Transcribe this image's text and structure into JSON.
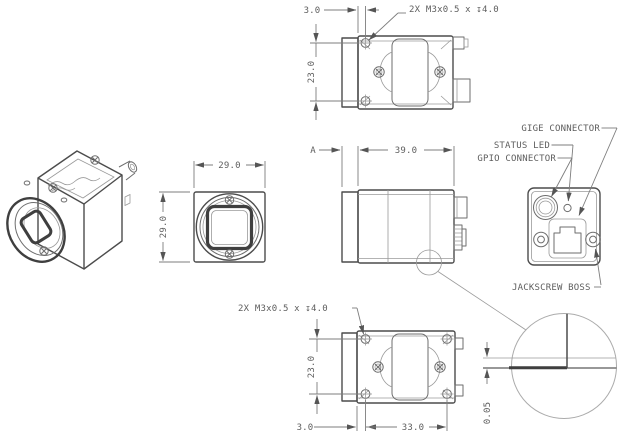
{
  "drawing_type": "camera-mechanical-drawing",
  "colors": {
    "line": "#4c4c4c",
    "thin_line": "#9a9a9a",
    "dimension": "#7d7d7d",
    "text": "#5e5e5e",
    "background": "#ffffff"
  },
  "views": {
    "top": {
      "dim_offset": "3.0",
      "thread_note": "2X M3x0.5 x ↧4.0",
      "dim_spacing": "23.0"
    },
    "front": {
      "dim_width": "29.0",
      "dim_height": "29.0"
    },
    "side": {
      "datum": "A",
      "dim_length": "39.0"
    },
    "rear": {
      "label_gige": "GIGE CONNECTOR",
      "label_status": "STATUS LED",
      "label_gpio": "GPIO CONNECTOR",
      "label_jackscrew": "JACKSCREW BOSS"
    },
    "bottom": {
      "thread_note": "2X M3x0.5 x ↧4.0",
      "dim_spacing": "23.0",
      "dim_offset": "3.0",
      "dim_pitch": "33.0"
    },
    "detail": {
      "dim_gap": "0.05"
    }
  }
}
